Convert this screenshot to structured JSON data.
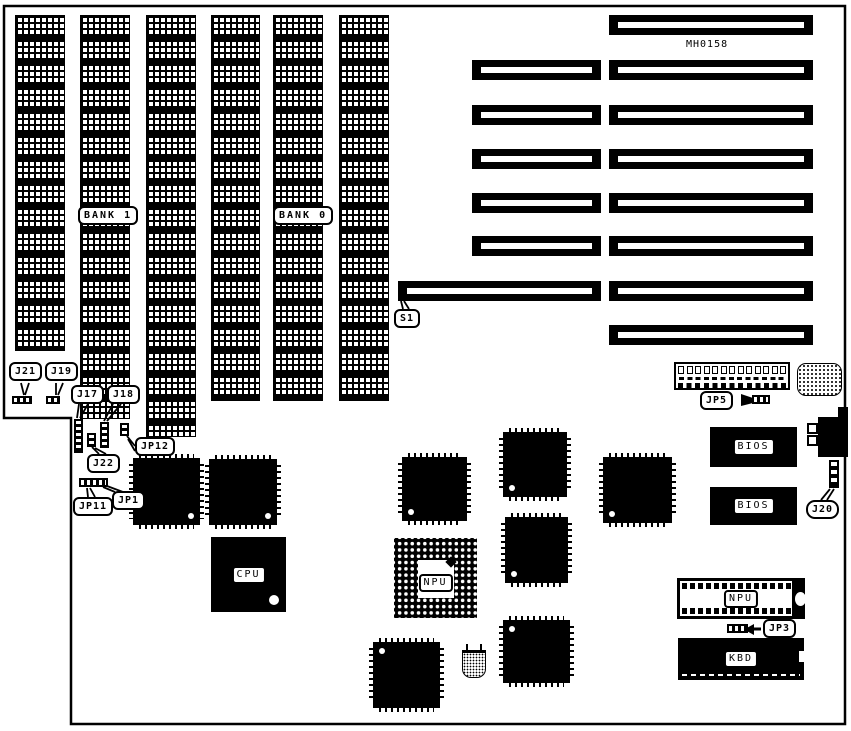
{
  "board": {
    "model_text": "MH0158",
    "bank_labels": {
      "bank1": "BANK 1",
      "bank0": "BANK 0"
    },
    "callouts": {
      "s1": "S1",
      "j21": "J21",
      "j19": "J19",
      "j17": "J17",
      "j18": "J18",
      "j22": "J22",
      "jp12": "JP12",
      "jp11": "JP11",
      "jp1": "JP1",
      "jp5": "JP5",
      "j20": "J20",
      "jp3": "JP3"
    },
    "chips": {
      "cpu": "CPU",
      "npu_pga": "NPU",
      "npu_dip": "NPU",
      "bios_upper": "BIOS",
      "bios_lower": "BIOS",
      "keyboard_controller": "KBD"
    }
  }
}
